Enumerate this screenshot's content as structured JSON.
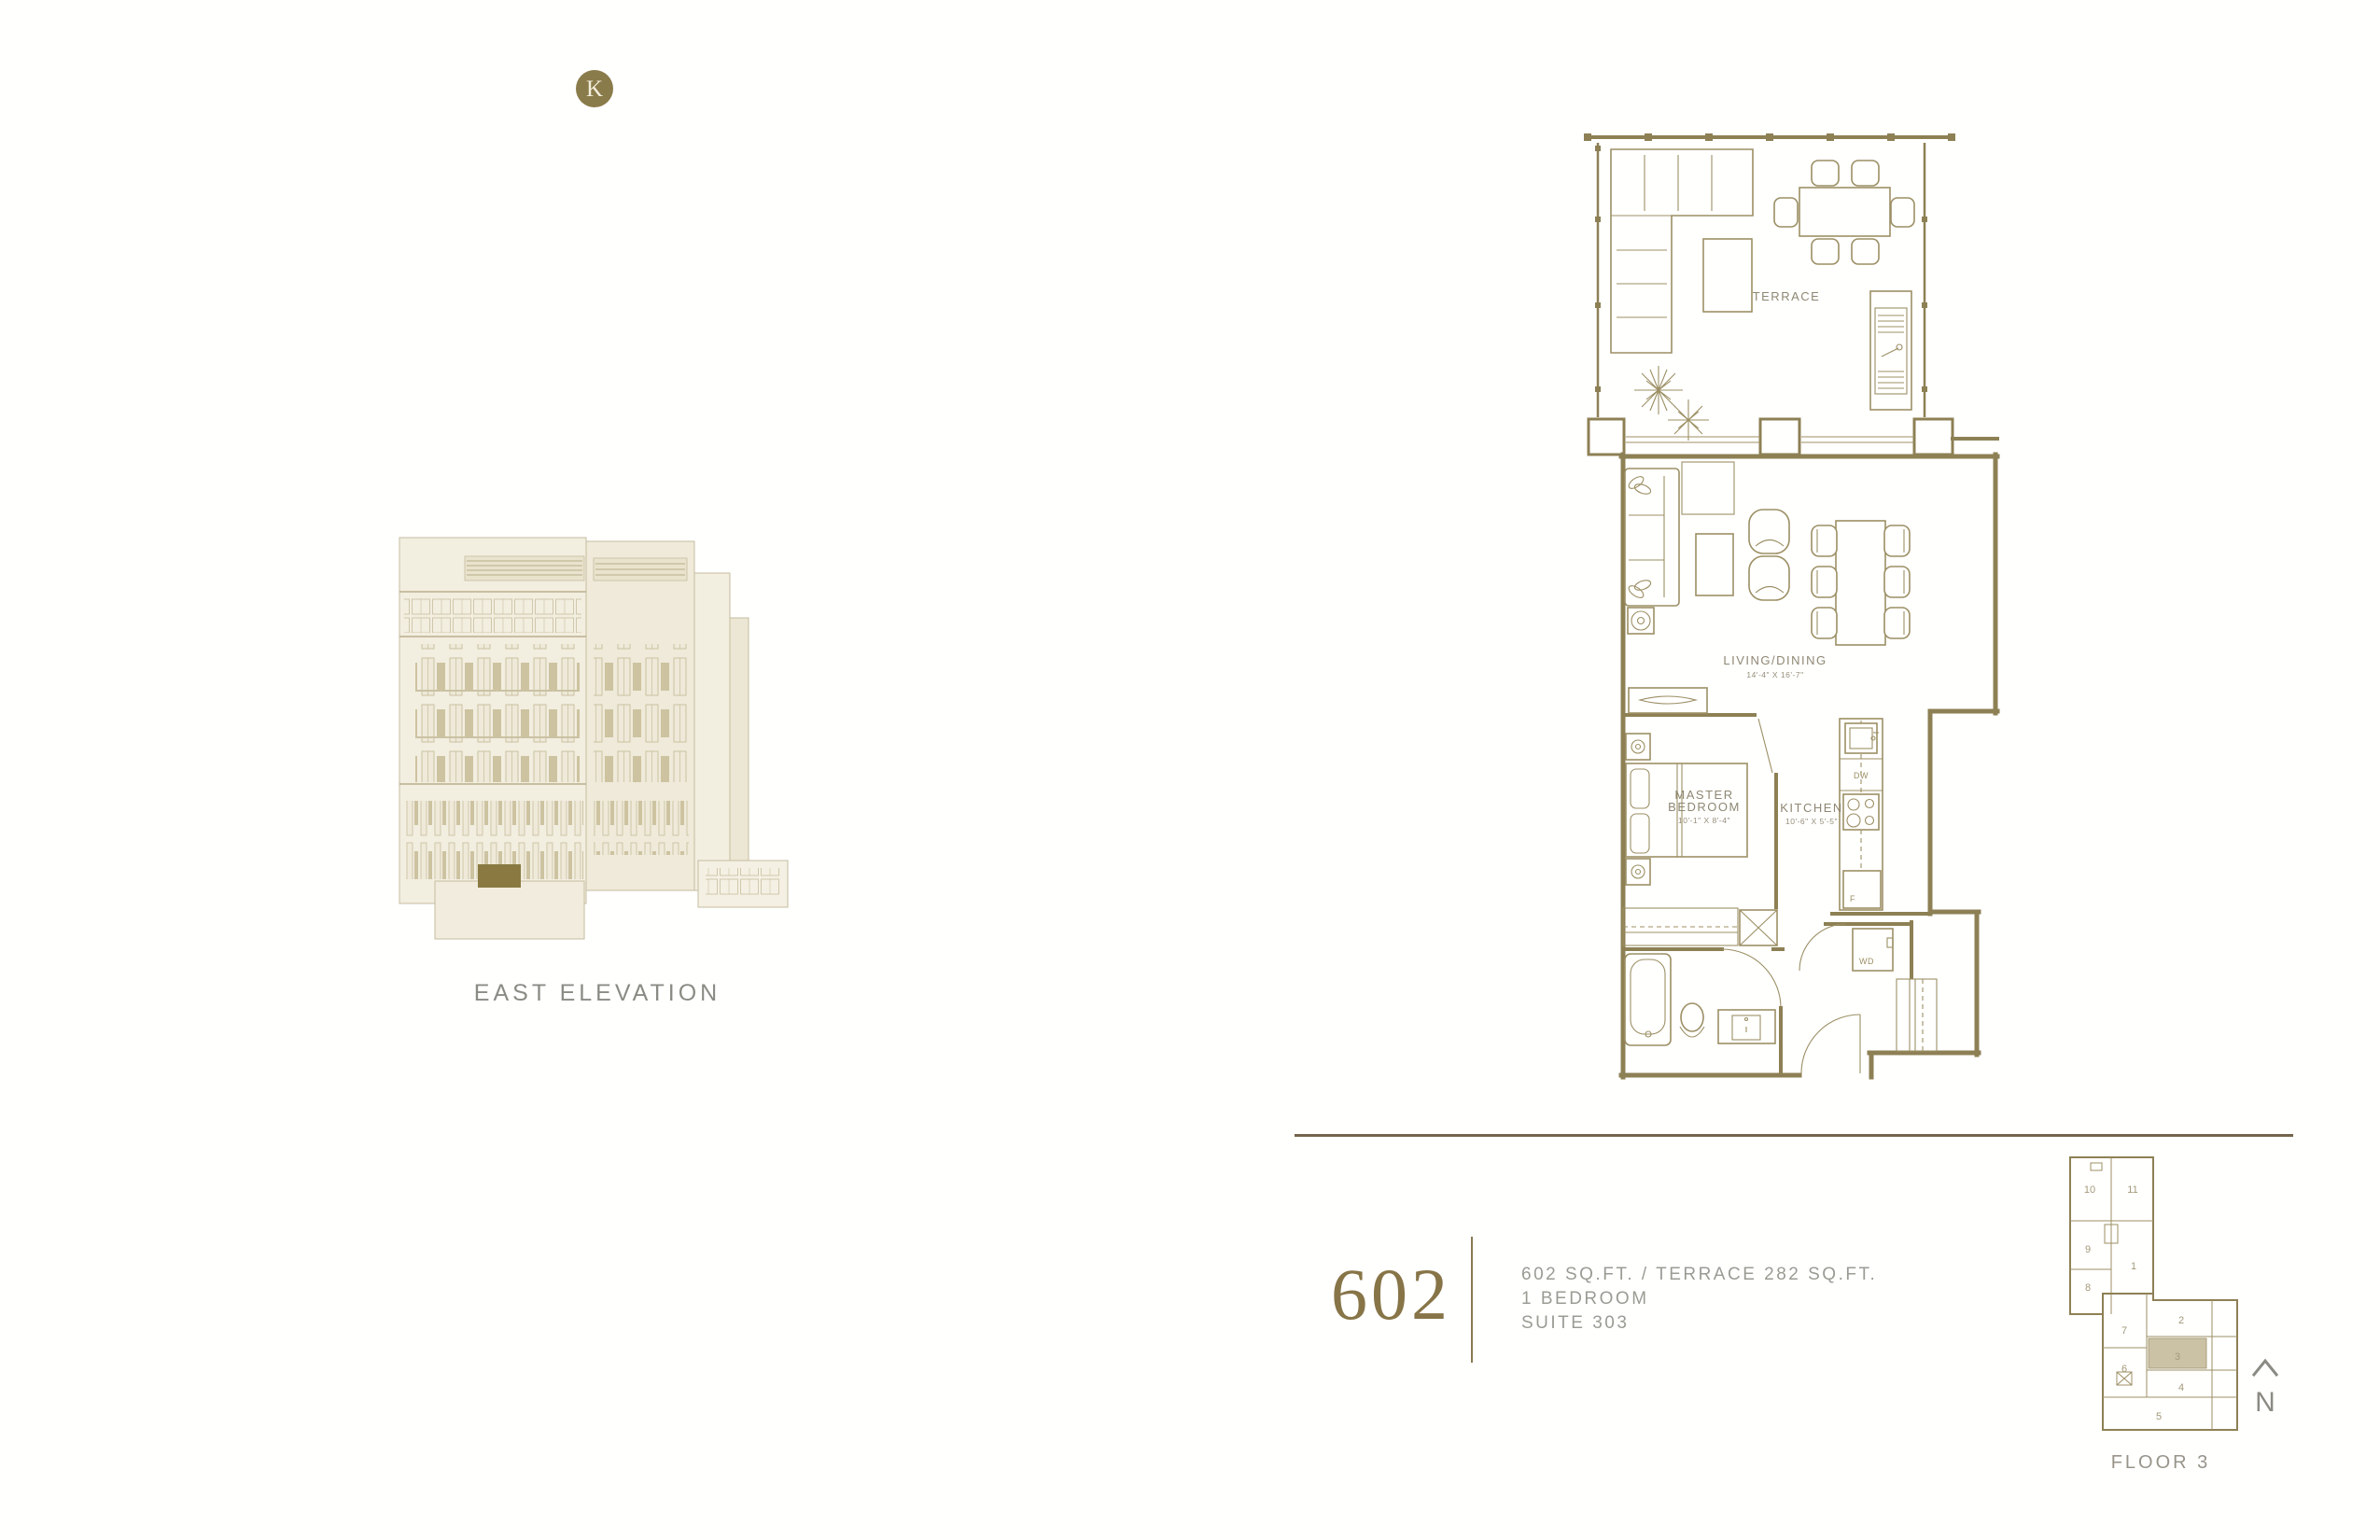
{
  "colors": {
    "accent_gold": "#8a7b4a",
    "drawing_olive": "#8d8054",
    "highlight_unit_fill": "#cbc2a6",
    "elevation_highlight": "#8a7a42",
    "divider_brown": "#73654c",
    "caption_gray": "#8b8b85"
  },
  "logo": {
    "letter": "K"
  },
  "elevation": {
    "caption": "EAST ELEVATION"
  },
  "floor_plan": {
    "terrace_label": "TERRACE",
    "living_label": "LIVING/DINING",
    "living_dims": "14'-4\" X 16'-7\"",
    "master_label_line1": "MASTER",
    "master_label_line2": "BEDROOM",
    "master_dims": "10'-1\" X 8'-4\"",
    "kitchen_label": "KITCHEN",
    "kitchen_dims": "10'-6\" X 5'-5\"",
    "dishwasher": "DW",
    "fridge": "F",
    "washer_dryer": "WD"
  },
  "suite_info": {
    "number": "602",
    "area_line": "602 SQ.FT. / TERRACE 282 SQ.FT.",
    "bedroom_line": "1 BEDROOM",
    "suite_line": "SUITE 303"
  },
  "key_plan": {
    "floor_label": "FLOOR 3",
    "north_label": "N",
    "highlighted_unit": "3",
    "units": [
      "10",
      "11",
      "9",
      "1",
      "8",
      "7",
      "2",
      "6",
      "3",
      "4",
      "5"
    ]
  }
}
